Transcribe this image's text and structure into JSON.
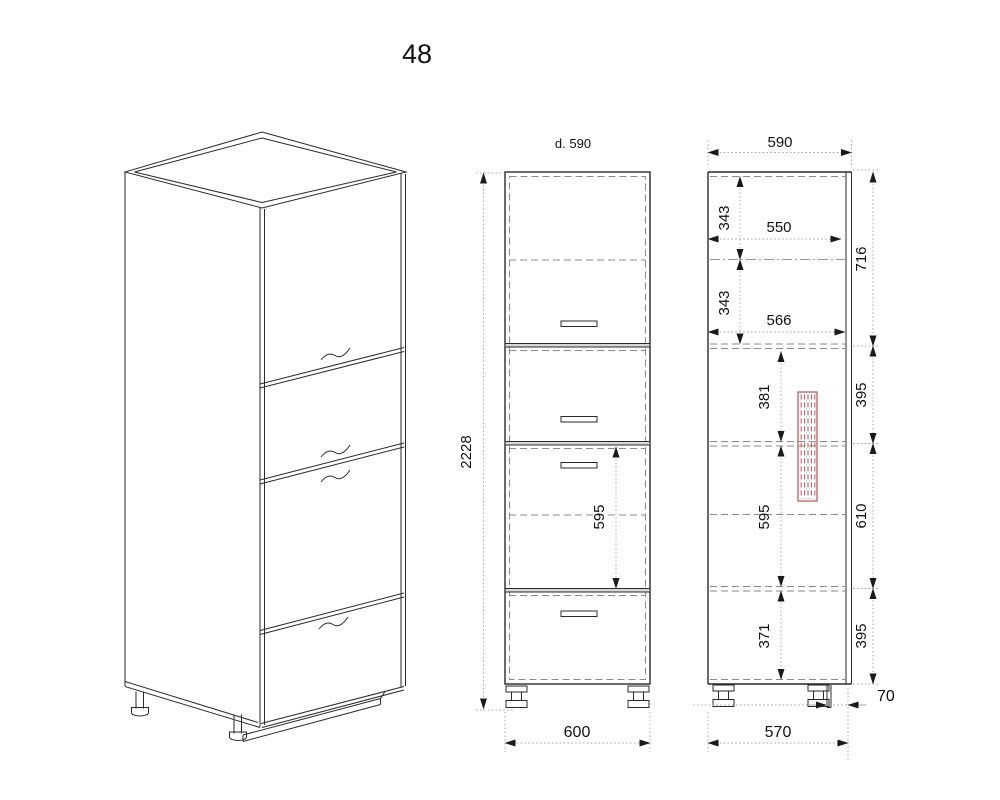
{
  "title": "48",
  "views": {
    "front": {
      "top_label": "d. 590",
      "height": "2228",
      "drawer_height": "595",
      "width": "600"
    },
    "side": {
      "depth": "590",
      "top_compartment": "343",
      "inner_depth_top": "550",
      "second_compartment": "343",
      "inner_depth_mid": "566",
      "compartment_a": "381",
      "compartment_b": "595",
      "compartment_c": "371",
      "right_chain": [
        "716",
        "395",
        "610",
        "395"
      ],
      "plinth_offset": "70",
      "bottom_depth": "570"
    }
  },
  "colors": {
    "line": "#2a2a2a",
    "hidden_dash": "#8b8b8b",
    "dimension": "#a6a6a6",
    "accent_red": "#c0504d",
    "band_fill": "#d8d8d8"
  }
}
